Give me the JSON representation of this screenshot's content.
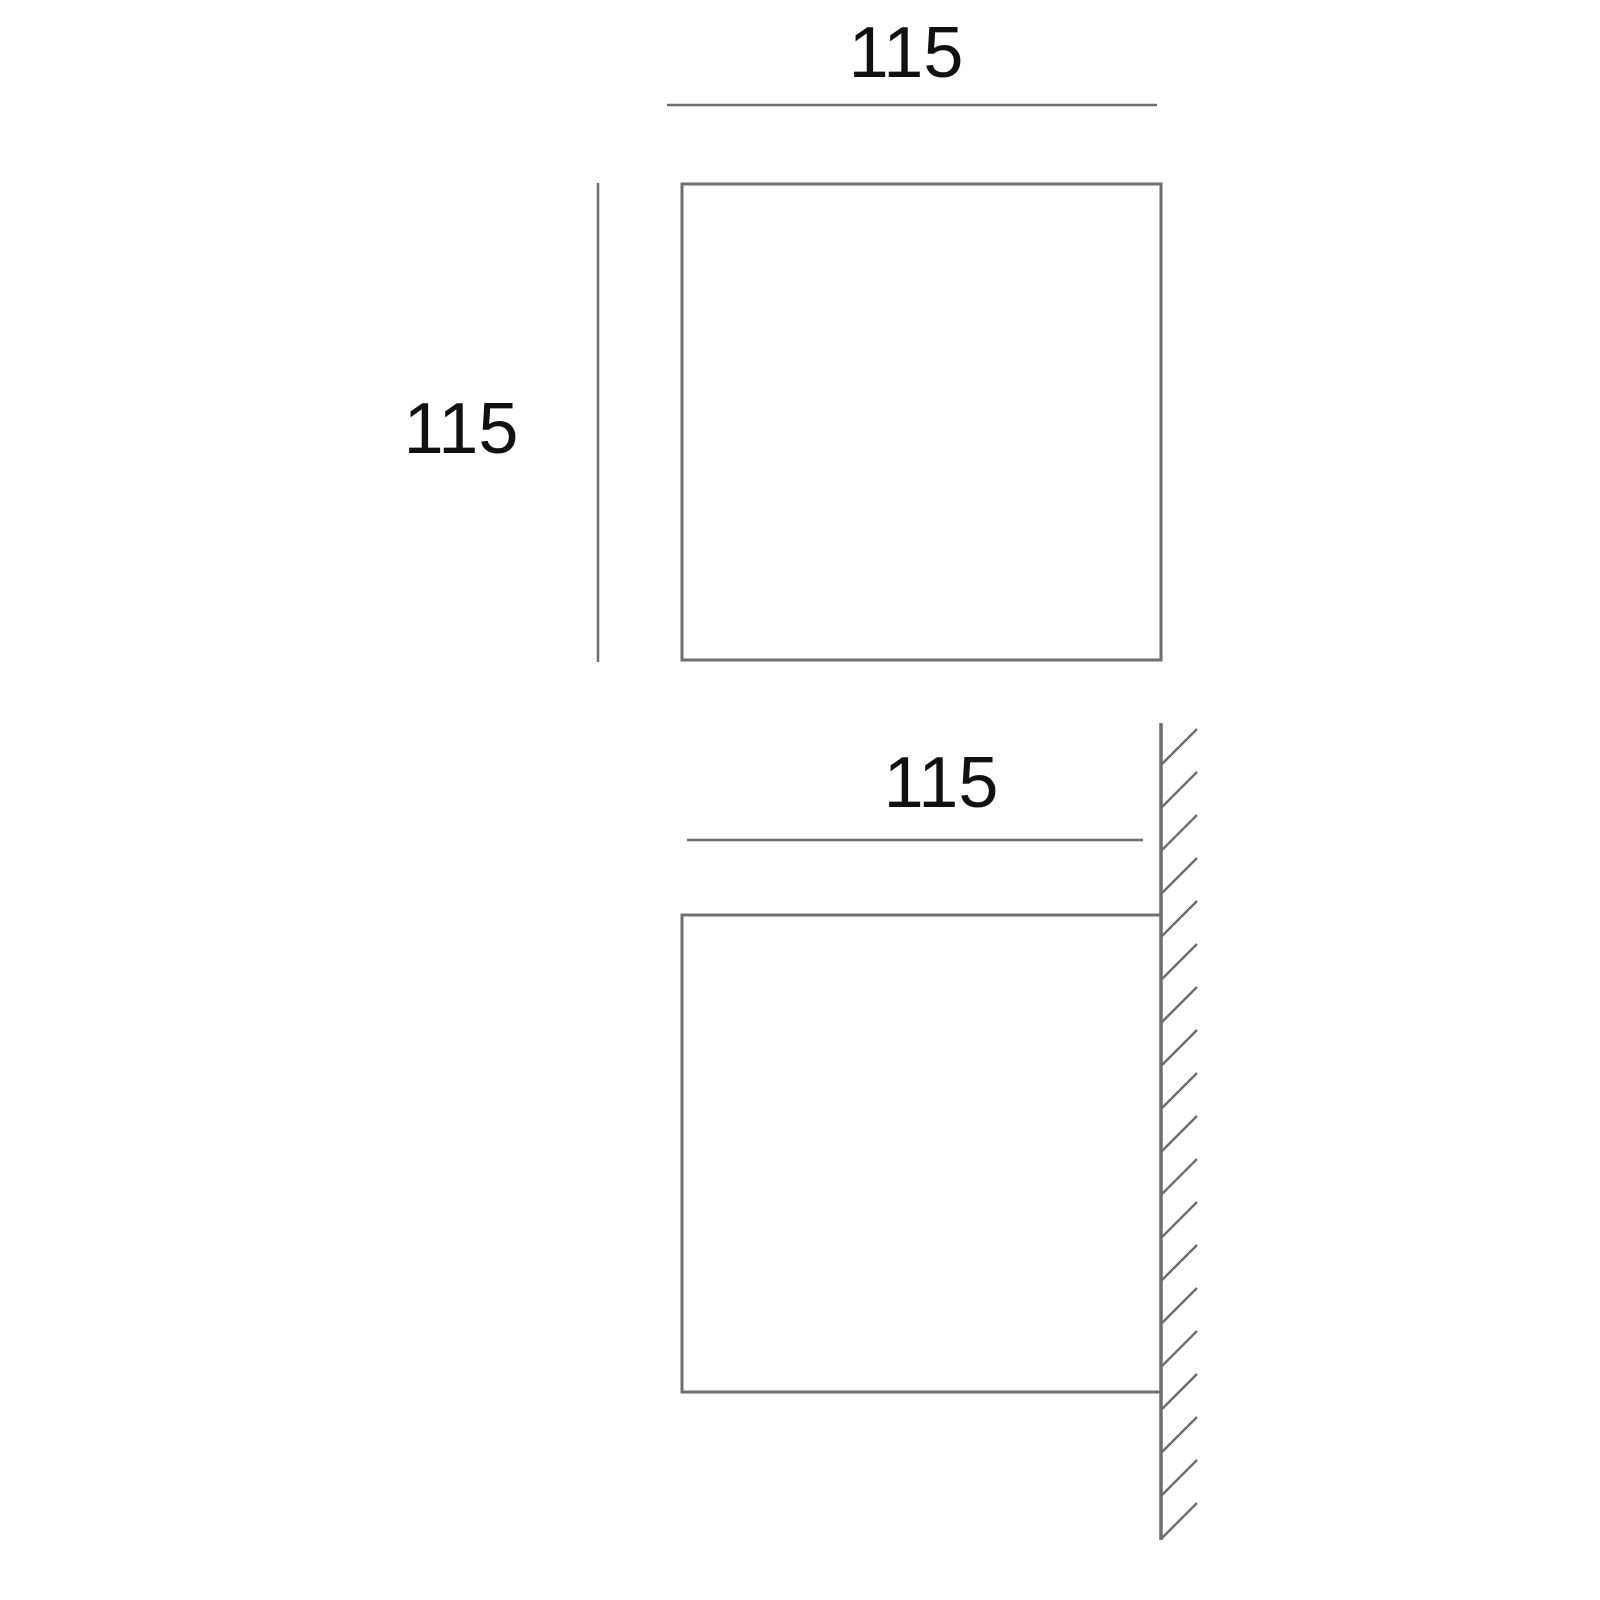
{
  "drawing": {
    "type": "technical-dimension-drawing",
    "background_color": "#ffffff",
    "line_color": "#6f6f6f",
    "text_color": "#111111",
    "top_view": {
      "width_label": "115",
      "height_label": "115"
    },
    "front_view": {
      "width_label": "115",
      "wall_hatch_count": 19
    }
  }
}
